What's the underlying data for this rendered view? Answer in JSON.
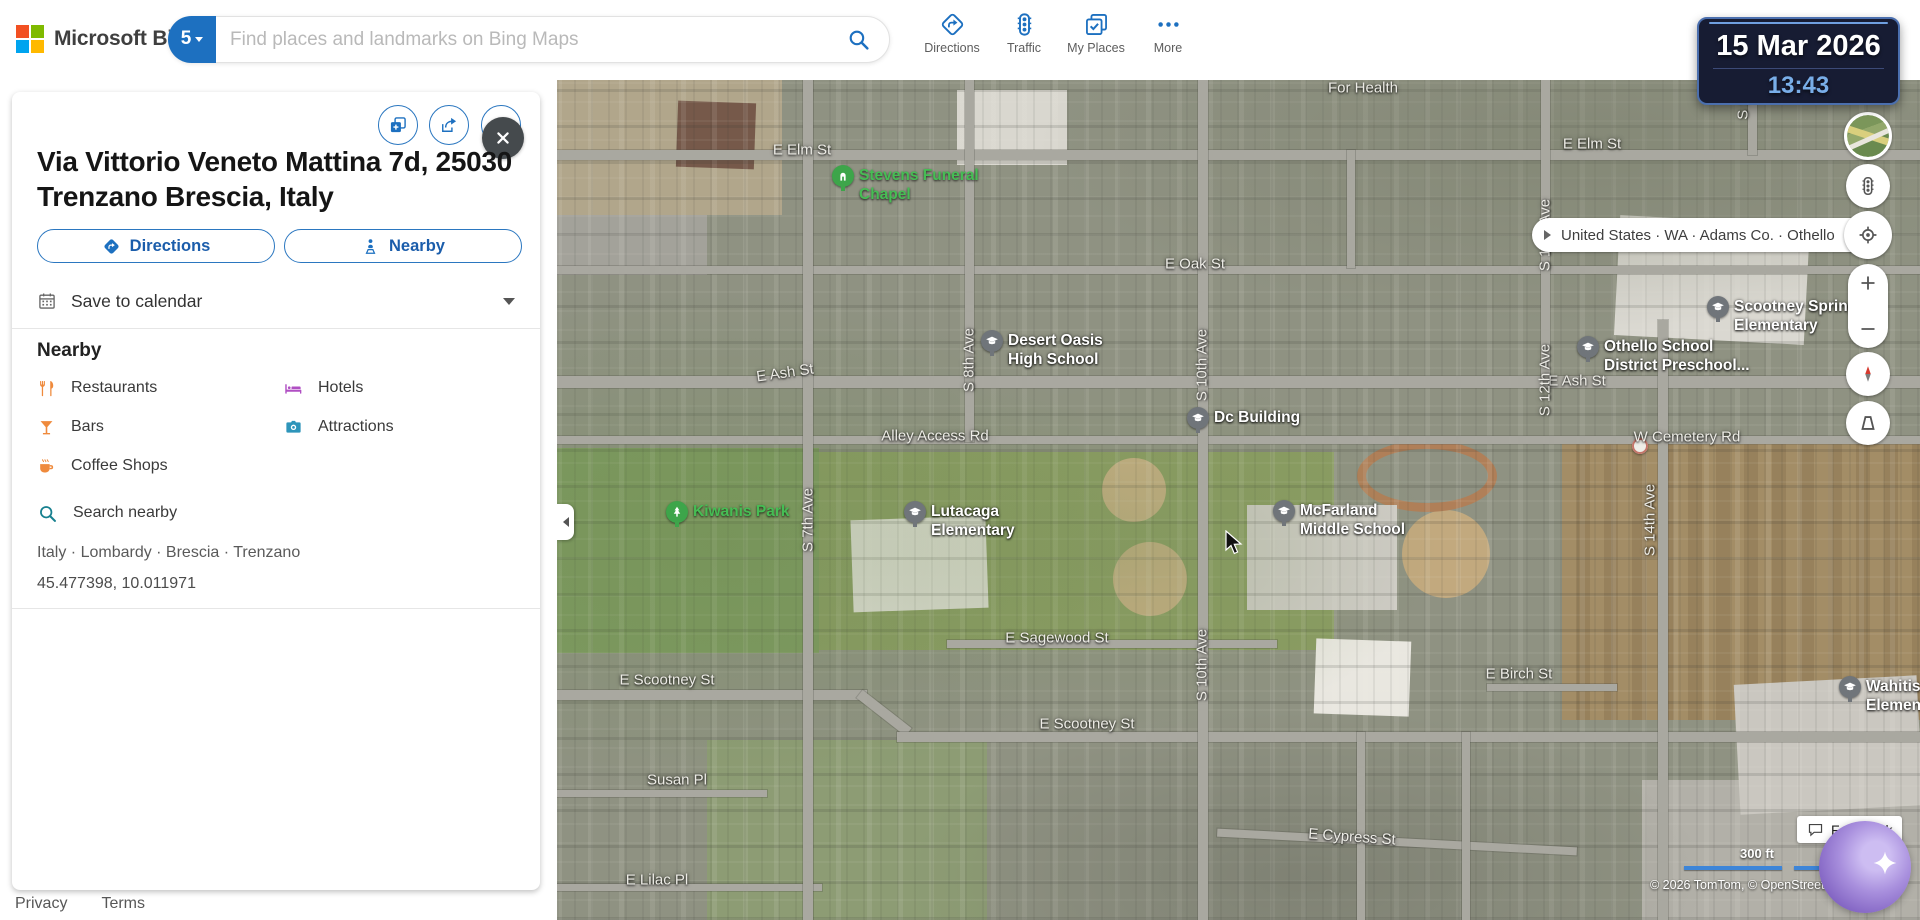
{
  "colors": {
    "accent": "#1d70c0",
    "link": "#1b5dab",
    "marker_green": "#3da54a",
    "marker_gray": "#70757a",
    "scale_blue": "#3d85d8"
  },
  "topbar": {
    "logo_text": "Microsoft Bing",
    "search": {
      "badge": "5",
      "placeholder": "Find places and landmarks on Bing Maps"
    },
    "nav_items": [
      {
        "label": "Directions",
        "icon": "directions"
      },
      {
        "label": "Traffic",
        "icon": "traffic"
      },
      {
        "label": "My Places",
        "icon": "myplaces"
      },
      {
        "label": "More",
        "icon": "more"
      }
    ]
  },
  "clock": {
    "date": "15 Mar 2026",
    "time": "13:43"
  },
  "panel": {
    "title_lines": [
      "Via Vittorio Veneto Mattina 7d, 25030",
      "Trenzano Brescia, Italy"
    ],
    "directions_label": "Directions",
    "nearby_label": "Nearby",
    "save_to_calendar_label": "Save to calendar",
    "nearby_heading": "Nearby",
    "nearby_items": [
      {
        "label": "Restaurants",
        "icon": "restaurants",
        "color": "#ef8a3c"
      },
      {
        "label": "Hotels",
        "icon": "hotels",
        "color": "#b04fc3"
      },
      {
        "label": "Bars",
        "icon": "bars",
        "color": "#ef8a3c"
      },
      {
        "label": "Attractions",
        "icon": "attractions",
        "color": "#2e95ba"
      },
      {
        "label": "Coffee Shops",
        "icon": "coffee",
        "color": "#ef8a3c"
      },
      {
        "label": "Search nearby",
        "icon": "search",
        "color": "#17808f",
        "full_row": true
      }
    ],
    "breadcrumb": "Italy · Lombardy · Brescia · Trenzano",
    "coordinates": "45.477398, 10.011971",
    "footer_links": [
      "Privacy",
      "Terms"
    ]
  },
  "map": {
    "region_breadcrumb": [
      "United States",
      "WA",
      "Adams Co.",
      "Othello"
    ],
    "scale_label": "300 ft",
    "copyright": "© 2026 TomTom,  © OpenStreetMap, © Ve",
    "feedback_label": "Feedback",
    "street_labels": [
      {
        "t": "For Health",
        "x": 806,
        "y": 8
      },
      {
        "t": "E Elm St",
        "x": 245,
        "y": 70
      },
      {
        "t": "E Elm St",
        "x": 1035,
        "y": 64
      },
      {
        "t": "E Oak St",
        "x": 638,
        "y": 184
      },
      {
        "t": "E Ash St",
        "x": 228,
        "y": 293,
        "r": -8
      },
      {
        "t": "E Ash St",
        "x": 1020,
        "y": 301
      },
      {
        "t": "Alley Access Rd",
        "x": 378,
        "y": 356
      },
      {
        "t": "W Cemetery Rd",
        "x": 1130,
        "y": 357
      },
      {
        "t": "E Sagewood St",
        "x": 500,
        "y": 558
      },
      {
        "t": "E Scootney St",
        "x": 110,
        "y": 600
      },
      {
        "t": "E Scootney St",
        "x": 530,
        "y": 644
      },
      {
        "t": "Susan Pl",
        "x": 120,
        "y": 700
      },
      {
        "t": "E Cypress St",
        "x": 795,
        "y": 757,
        "r": 4
      },
      {
        "t": "E Lilac Pl",
        "x": 100,
        "y": 800
      },
      {
        "t": "E Birch St",
        "x": 962,
        "y": 594
      },
      {
        "t": "S 7th Ave",
        "x": 251,
        "y": 440,
        "r": -90
      },
      {
        "t": "S 8th Ave",
        "x": 412,
        "y": 280,
        "r": -90
      },
      {
        "t": "S 10th Ave",
        "x": 645,
        "y": 285,
        "r": -90
      },
      {
        "t": "S 10th Ave",
        "x": 645,
        "y": 585,
        "r": -90
      },
      {
        "t": "S 12th Ave",
        "x": 988,
        "y": 300,
        "r": -90
      },
      {
        "t": "S 13th Ave",
        "x": 988,
        "y": 155,
        "r": -90
      },
      {
        "t": "S 14th Ave",
        "x": 1093,
        "y": 440,
        "r": -90
      },
      {
        "t": "S 15th",
        "x": 1186,
        "y": 18,
        "r": -90
      }
    ],
    "places": [
      {
        "type": "funeral",
        "glyph": "chapel",
        "x": 286,
        "y": 96,
        "lines": [
          "Stevens Funeral",
          "Chapel"
        ]
      },
      {
        "type": "school",
        "glyph": "gradcap",
        "x": 435,
        "y": 261,
        "lines": [
          "Desert Oasis",
          "High School"
        ]
      },
      {
        "type": "school",
        "glyph": "gradcap",
        "x": 641,
        "y": 338,
        "lines": [
          "Dc Building"
        ]
      },
      {
        "type": "park",
        "glyph": "tree",
        "x": 120,
        "y": 432,
        "lines": [
          "Kiwanis Park"
        ]
      },
      {
        "type": "school",
        "glyph": "gradcap",
        "x": 358,
        "y": 432,
        "lines": [
          "Lutacaga",
          "Elementary"
        ]
      },
      {
        "type": "school",
        "glyph": "gradcap",
        "x": 727,
        "y": 431,
        "lines": [
          "McFarland",
          "Middle School"
        ]
      },
      {
        "type": "school",
        "glyph": "gradcap",
        "x": 1161,
        "y": 227,
        "lines": [
          "Scootney Springs",
          "Elementary"
        ]
      },
      {
        "type": "school",
        "glyph": "gradcap",
        "x": 1031,
        "y": 267,
        "lines": [
          "Othello School",
          "District Preschool..."
        ]
      },
      {
        "type": "school",
        "glyph": "gradcap",
        "x": 1293,
        "y": 607,
        "lines": [
          "Wahitis",
          "Elementary"
        ]
      }
    ],
    "roads": [
      {
        "x": 0,
        "y": 70,
        "w": 1363,
        "h": 10
      },
      {
        "x": 0,
        "y": 186,
        "w": 1363,
        "h": 8
      },
      {
        "x": 0,
        "y": 296,
        "w": 1363,
        "h": 12
      },
      {
        "x": 0,
        "y": 356,
        "w": 1363,
        "h": 8
      },
      {
        "x": 390,
        "y": 560,
        "w": 330,
        "h": 8
      },
      {
        "x": 0,
        "y": 610,
        "w": 310,
        "h": 10
      },
      {
        "x": 296,
        "y": 628,
        "w": 62,
        "h": 10,
        "rot": 38
      },
      {
        "x": 340,
        "y": 652,
        "w": 1023,
        "h": 10
      },
      {
        "x": 0,
        "y": 710,
        "w": 210,
        "h": 7
      },
      {
        "x": 660,
        "y": 758,
        "w": 360,
        "h": 8,
        "rot": 3
      },
      {
        "x": 0,
        "y": 804,
        "w": 265,
        "h": 7
      },
      {
        "x": 930,
        "y": 604,
        "w": 130,
        "h": 7
      },
      {
        "x": 246,
        "y": 0,
        "w": 10,
        "h": 840
      },
      {
        "x": 408,
        "y": 0,
        "w": 9,
        "h": 362
      },
      {
        "x": 641,
        "y": 0,
        "w": 10,
        "h": 840
      },
      {
        "x": 984,
        "y": 0,
        "w": 9,
        "h": 300
      },
      {
        "x": 1101,
        "y": 240,
        "w": 10,
        "h": 600
      },
      {
        "x": 1191,
        "y": 0,
        "w": 9,
        "h": 75
      },
      {
        "x": 800,
        "y": 652,
        "w": 8,
        "h": 188
      },
      {
        "x": 905,
        "y": 652,
        "w": 8,
        "h": 188
      },
      {
        "x": 790,
        "y": 70,
        "w": 8,
        "h": 118
      }
    ]
  }
}
